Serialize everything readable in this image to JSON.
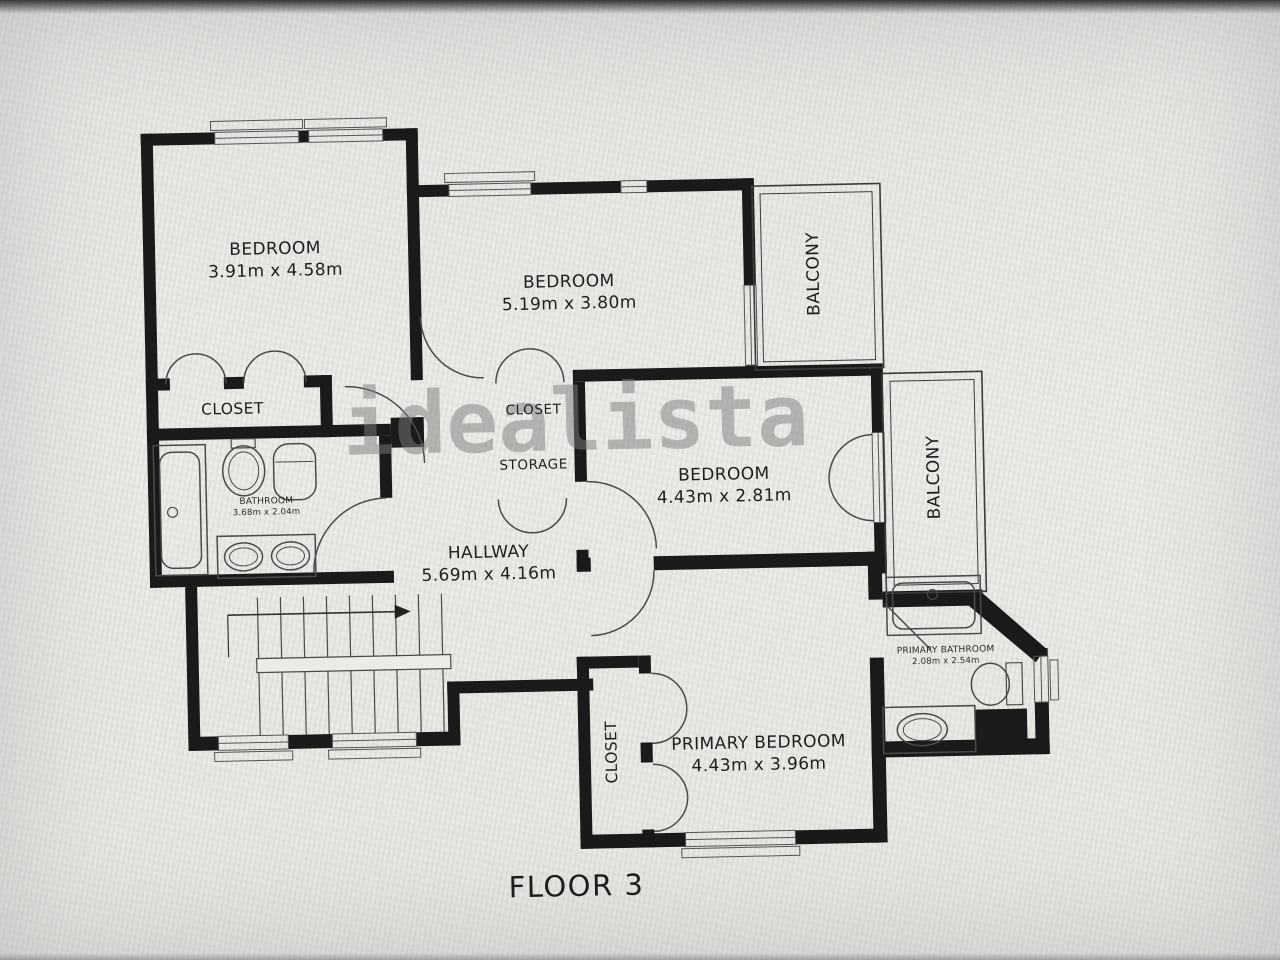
{
  "floor_label": "FLOOR 3",
  "watermark": "idealista",
  "rooms": [
    {
      "id": "bedroom-top-left",
      "name": "BEDROOM",
      "dimensions": "3.91m x 4.58m"
    },
    {
      "id": "bedroom-top-middle",
      "name": "BEDROOM",
      "dimensions": "5.19m x 3.80m"
    },
    {
      "id": "balcony-top",
      "name": "BALCONY"
    },
    {
      "id": "closet-left",
      "name": "CLOSET"
    },
    {
      "id": "bathroom",
      "name": "BATHROOM",
      "dimensions": "3.68m x 2.04m"
    },
    {
      "id": "closet-middle",
      "name": "CLOSET"
    },
    {
      "id": "storage",
      "name": "STORAGE"
    },
    {
      "id": "bedroom-middle-right",
      "name": "BEDROOM",
      "dimensions": "4.43m x 2.81m"
    },
    {
      "id": "balcony-right",
      "name": "BALCONY"
    },
    {
      "id": "hallway",
      "name": "HALLWAY",
      "dimensions": "5.69m x 4.16m"
    },
    {
      "id": "primary-bathroom",
      "name": "PRIMARY BATHROOM",
      "dimensions": "2.08m x 2.54m"
    },
    {
      "id": "closet-primary",
      "name": "CLOSET"
    },
    {
      "id": "primary-bedroom",
      "name": "PRIMARY BEDROOM",
      "dimensions": "4.43m x 3.96m"
    }
  ],
  "colors": {
    "wall": "#1a1a1a",
    "paper": "#e9e8e4",
    "fixture_line": "#4a4a4a",
    "watermark": "#7c7c7c"
  }
}
